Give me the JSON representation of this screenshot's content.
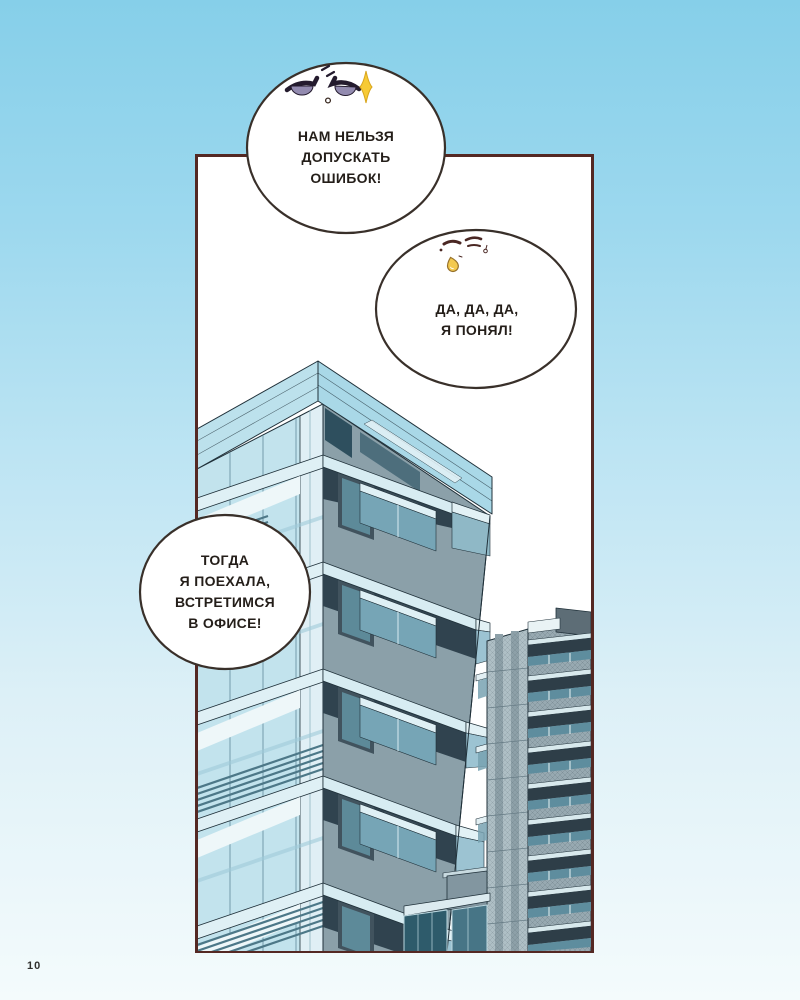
{
  "page": {
    "number": "10"
  },
  "colors": {
    "sky_top": "#86cfe9",
    "sky_bottom": "#f4fbfc",
    "panel_border": "#542823",
    "panel_background": "#ffffff",
    "bubble_fill": "#ffffff",
    "bubble_outline": "#39302a",
    "text_color": "#241e19",
    "building_glass": "#c2e3ed",
    "building_slab": "#dff0f5",
    "building_dark_slate": "#30434f",
    "building_gray": "#8ba0a9",
    "eye_iris": "#938bb0",
    "spark_yellow": "#f7ca35",
    "sweat_drop_yellow": "#f3c94e"
  },
  "speech_bubbles": [
    {
      "face": "angry-half-lidded-eyes-with-spark",
      "lines": [
        "НАМ НЕЛЬЗЯ",
        "ДОПУСКАТЬ",
        "ОШИБОК!"
      ]
    },
    {
      "face": "closed-annoyed-eyes-with-sweat-drop",
      "lines": [
        "ДА, ДА, ДА,",
        "Я ПОНЯЛ!"
      ]
    },
    {
      "face": "none",
      "lines": [
        "ТОГДА",
        "Я ПОЕХАЛА,",
        "ВСТРЕТИМСЯ",
        "В ОФИСЕ!"
      ]
    }
  ],
  "scene": {
    "panel_subject": "low-angle view of two modern apartment towers against white sky",
    "buildings": [
      "main-glass-apartment-tower",
      "right-gray-apartment-tower",
      "low-glass-annex"
    ]
  }
}
